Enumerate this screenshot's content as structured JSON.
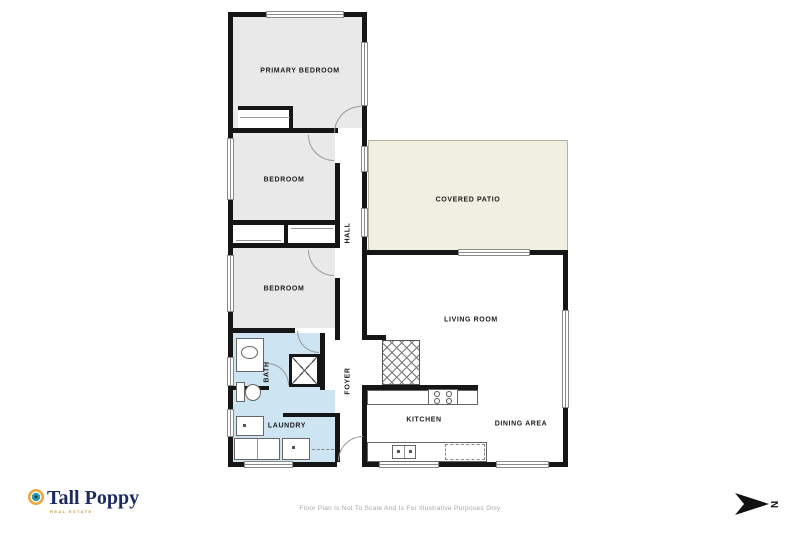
{
  "brand": {
    "name": "Tall Poppy",
    "tagline": "REAL ESTATE"
  },
  "rooms": {
    "primary_bedroom": "PRIMARY BEDROOM",
    "bedroom_2": "BEDROOM",
    "bedroom_3": "BEDROOM",
    "hall": "HALL",
    "covered_patio": "COVERED PATIO",
    "living_room": "LIVING ROOM",
    "bath": "BATH",
    "foyer": "FOYER",
    "laundry": "LAUNDRY",
    "kitchen": "KITCHEN",
    "dining_area": "DINING AREA"
  },
  "footer": {
    "disclaimer": "Floor Plan Is Not To Scale And Is For Illustrative Purposes Only"
  },
  "compass": {
    "label": "N"
  },
  "colors": {
    "wall": "#161616",
    "bedroom_fill": "#e9e9e9",
    "wet_area_fill": "#cde4f2",
    "patio_fill": "#f0efe2",
    "brand_navy": "#1d2a5f",
    "brand_gold": "#e9a63a",
    "brand_teal": "#2e9cb5"
  }
}
